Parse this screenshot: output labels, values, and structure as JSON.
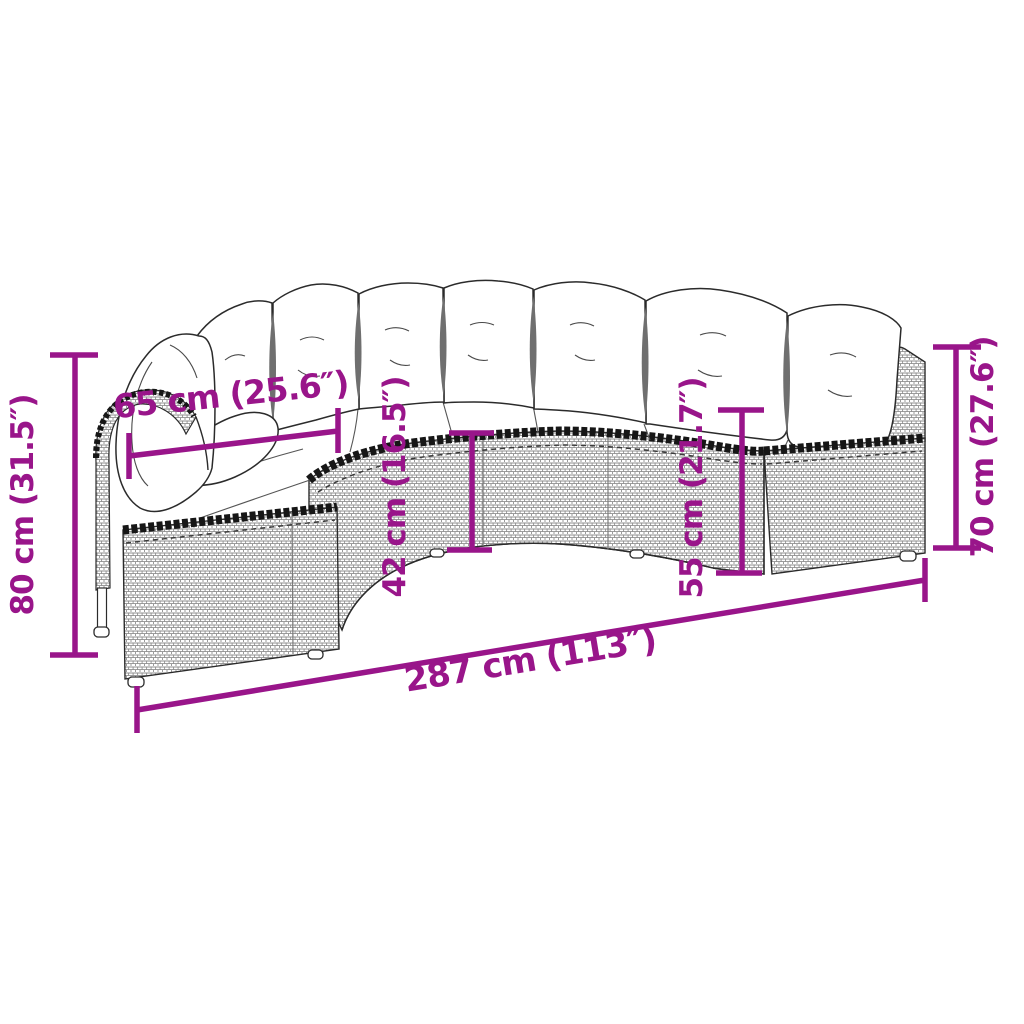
{
  "page": {
    "title": "Half-round garden sofa — dimension diagram",
    "background": "#ffffff"
  },
  "diagram": {
    "accent_color": "#99158A",
    "artwork_color": "#2b2b2b",
    "labels": {
      "height_left": "80 cm (31.5″)",
      "seat_depth": "65 cm (25.6″)",
      "seat_height": "42 cm (16.5″)",
      "back_height_inner": "55 cm (21.7″)",
      "height_right": "70 cm (27.6″)",
      "total_width": "287 cm (113″)"
    }
  }
}
